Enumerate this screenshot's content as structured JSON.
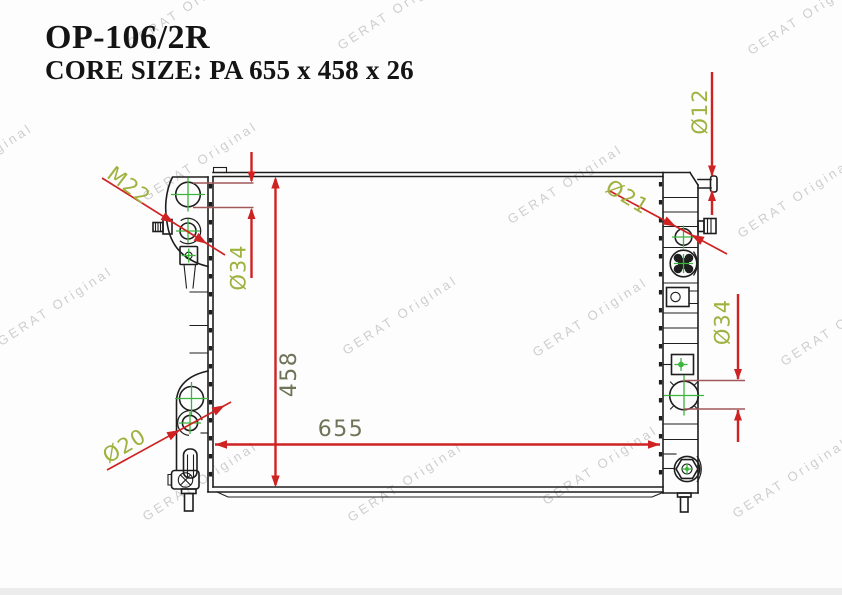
{
  "header": {
    "part_number": "OP-106/2R",
    "core_size": "CORE SIZE: PA 655 x 458 x 26"
  },
  "watermark": {
    "text": "GERAT Original"
  },
  "dims": {
    "thread": "M22",
    "dia34_left": "Ø34",
    "height": "458",
    "width": "655",
    "dia20": "Ø20",
    "dia12": "Ø12",
    "dia21": "Ø21",
    "dia34_right": "Ø34"
  },
  "colors": {
    "dimension_red": "#cf2222",
    "extension_red": "#a25858",
    "label_green": "#9fb23f",
    "label_olive": "#6e7457",
    "crosshair_green": "#3cb53c",
    "line_black": "#1e1e1e",
    "watermark_gray": "#a8a8a8"
  }
}
